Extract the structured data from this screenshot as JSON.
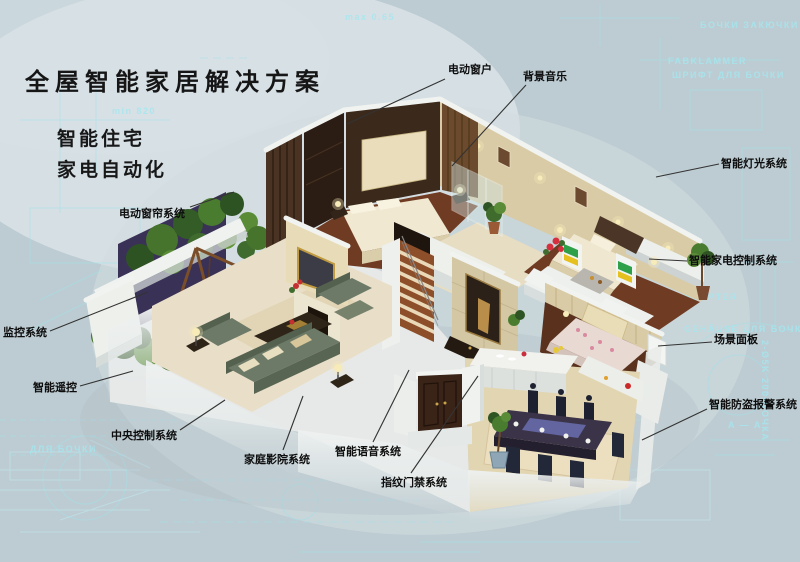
{
  "poster": {
    "title": "全屋智能家居解决方案",
    "subtitles": [
      "智能住宅",
      "家电自动化"
    ],
    "annotations": [
      {
        "id": "electric-window",
        "text": "电动窗户"
      },
      {
        "id": "background-music",
        "text": "背景音乐"
      },
      {
        "id": "smart-lighting",
        "text": "智能灯光系统"
      },
      {
        "id": "appliance-control",
        "text": "智能家电控制系统"
      },
      {
        "id": "scene-panel",
        "text": "场景面板"
      },
      {
        "id": "burglar-alarm",
        "text": "智能防盗报警系统"
      },
      {
        "id": "electric-curtain",
        "text": "电动窗帘系统"
      },
      {
        "id": "monitoring",
        "text": "监控系统"
      },
      {
        "id": "smart-remote",
        "text": "智能遥控"
      },
      {
        "id": "central-control",
        "text": "中央控制系统"
      },
      {
        "id": "home-theater",
        "text": "家庭影院系统"
      },
      {
        "id": "voice-system",
        "text": "智能语音系统"
      },
      {
        "id": "fingerprint-access",
        "text": "指纹门禁系统"
      }
    ],
    "background_words": [
      "max 0.65",
      "min 820",
      "БОЧКИ ЗАКЮЧКИ",
      "FABKLAMMER",
      "ШРИФТ ДЛЯ БОЧКИ",
      "GEHÄUSE ДЛЯ БОЧКИ",
      "ADAPTER",
      "A — A",
      "2-Ø5K 200-БОЧКА",
      "ДЛЯ БОЧКИ"
    ],
    "colors": {
      "background": "#bdccd2",
      "blueprint_line": "#9fe2ec",
      "label_text": "#0d0d0d",
      "leader_line": "#333333"
    }
  }
}
